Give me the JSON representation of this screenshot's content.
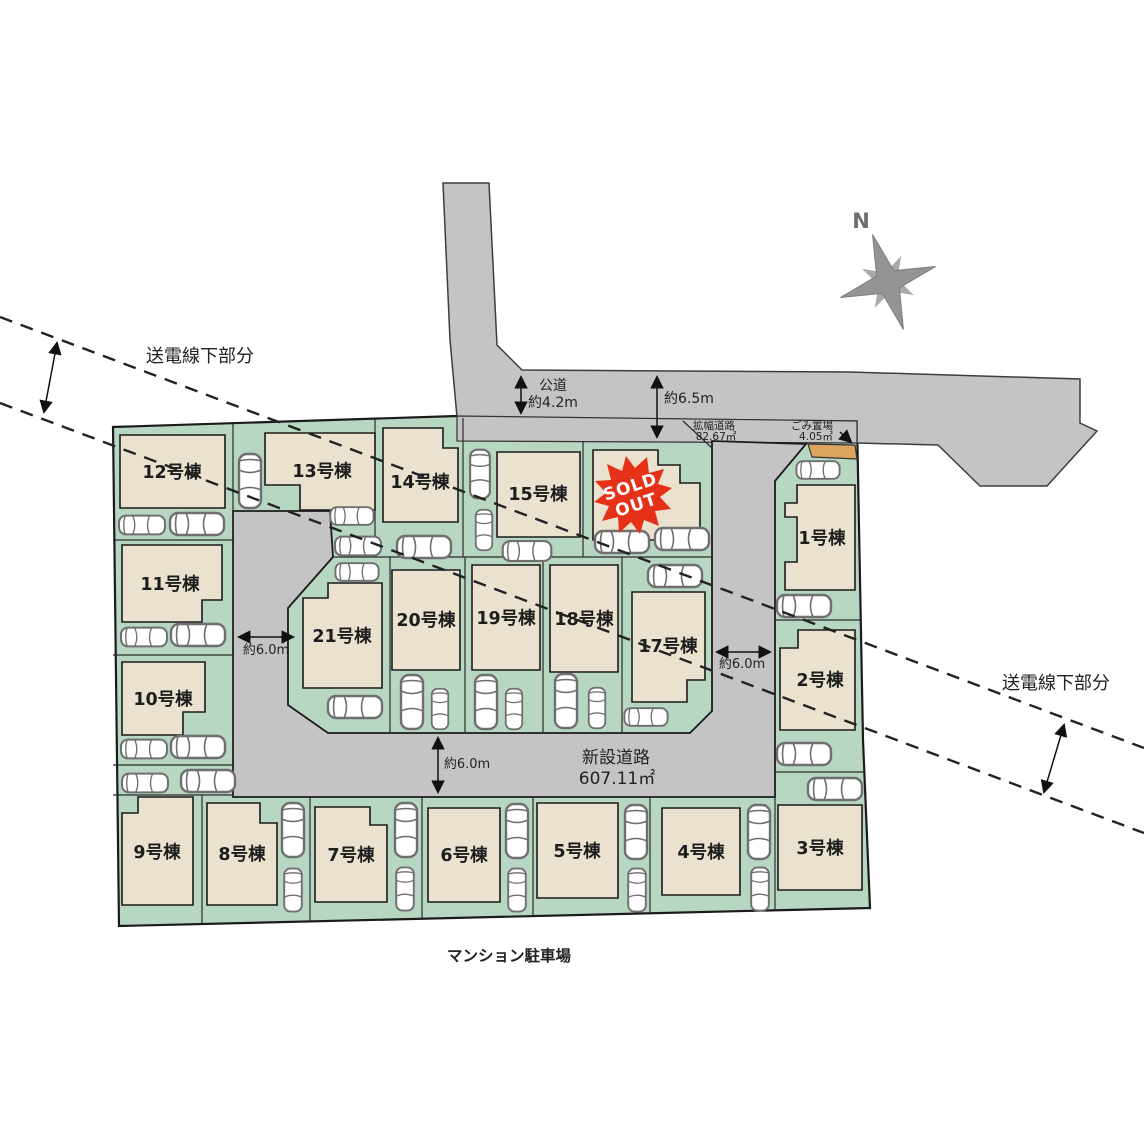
{
  "compass": {
    "north_label": "N"
  },
  "transmission_line": {
    "label_left": "送電線下部分",
    "label_right": "送電線下部分"
  },
  "roads": {
    "public_road_label": "公道",
    "public_road_width": "約4.2m",
    "total_frontage_width": "約6.5m",
    "widened_road_label": "拡幅道路",
    "widened_road_area": "82.67㎡",
    "garbage_station_label": "ごみ置場",
    "garbage_station_area": "4.05㎡",
    "new_road_label": "新設道路",
    "new_road_area": "607.11㎡",
    "width_left": "約6.0m",
    "width_right": "約6.0m",
    "width_bottom": "約6.0m"
  },
  "surroundings": {
    "mansion_parking_label": "マンション駐車場"
  },
  "lots": [
    {
      "label": "1号棟"
    },
    {
      "label": "2号棟"
    },
    {
      "label": "3号棟"
    },
    {
      "label": "4号棟"
    },
    {
      "label": "5号棟"
    },
    {
      "label": "6号棟"
    },
    {
      "label": "7号棟"
    },
    {
      "label": "8号棟"
    },
    {
      "label": "9号棟"
    },
    {
      "label": "10号棟"
    },
    {
      "label": "11号棟"
    },
    {
      "label": "12号棟"
    },
    {
      "label": "13号棟"
    },
    {
      "label": "14号棟"
    },
    {
      "label": "15号棟"
    },
    {
      "label": "17号棟"
    },
    {
      "label": "18号棟"
    },
    {
      "label": "19号棟"
    },
    {
      "label": "20号棟"
    },
    {
      "label": "21号棟"
    }
  ],
  "sold_out_badge": {
    "line1": "SOLD",
    "line2": "OUT"
  },
  "colors": {
    "lot_green": "#b7d7c2",
    "building_beige": "#eae2cf",
    "road_gray": "#c4c4c4",
    "garbage_orange": "#dda45f",
    "sold_red": "#e63119",
    "compass_gray": "#949494"
  }
}
